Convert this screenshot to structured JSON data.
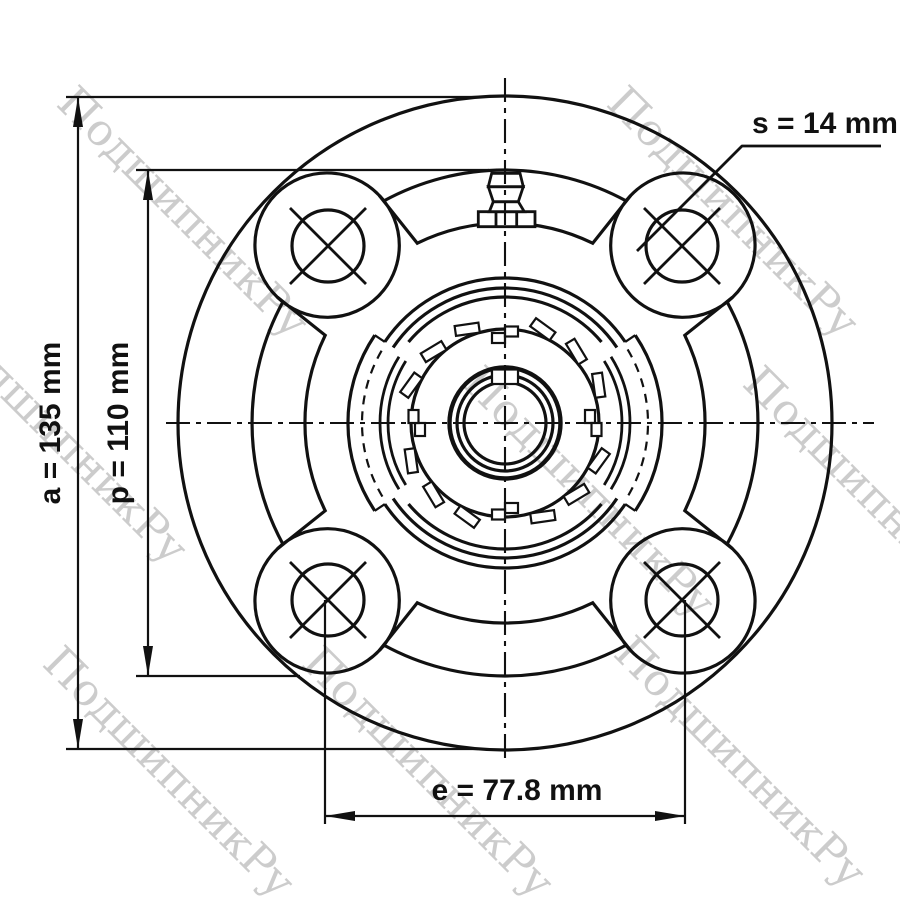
{
  "watermark": {
    "text": "ПодшипникРу"
  },
  "dimensions": {
    "a": {
      "label": "a = 135 mm"
    },
    "p": {
      "label": "p = 110 mm"
    },
    "s": {
      "label": "s = 14 mm"
    },
    "e": {
      "label": "e = 77.8 mm"
    }
  },
  "colors": {
    "line": "#111111",
    "watermark": "#c4c4c4",
    "background": "#ffffff"
  }
}
